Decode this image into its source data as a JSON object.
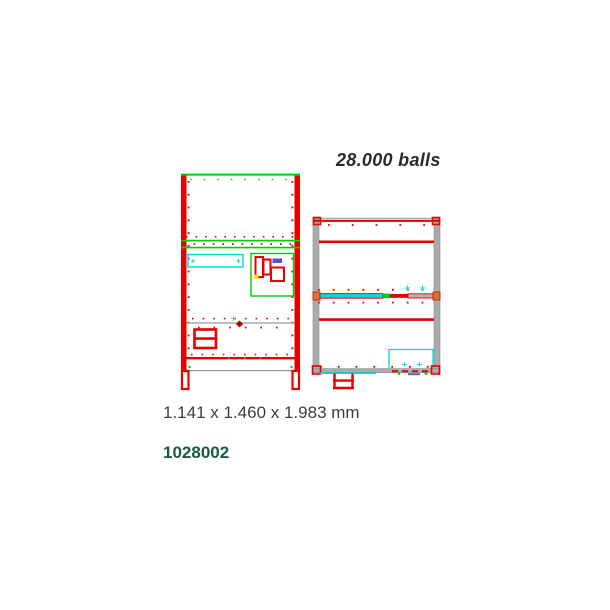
{
  "labels": {
    "capacity": "28.000 balls",
    "dimensions": "1.141 x 1.460 x 1.983 mm",
    "product_code": "1028002"
  },
  "colors": {
    "red": "#e60000",
    "dark_red": "#aa0000",
    "green": "#00cc00",
    "cyan": "#00d9d9",
    "gray": "#ababab",
    "line_gray": "#999999",
    "blue": "#5252cc",
    "yellow": "#ffe000",
    "orange": "#c2803a",
    "capacity_text": "#2b2b2b",
    "dimensions_text": "#3d3d3d",
    "product_code_text": "#1a5c3a"
  }
}
